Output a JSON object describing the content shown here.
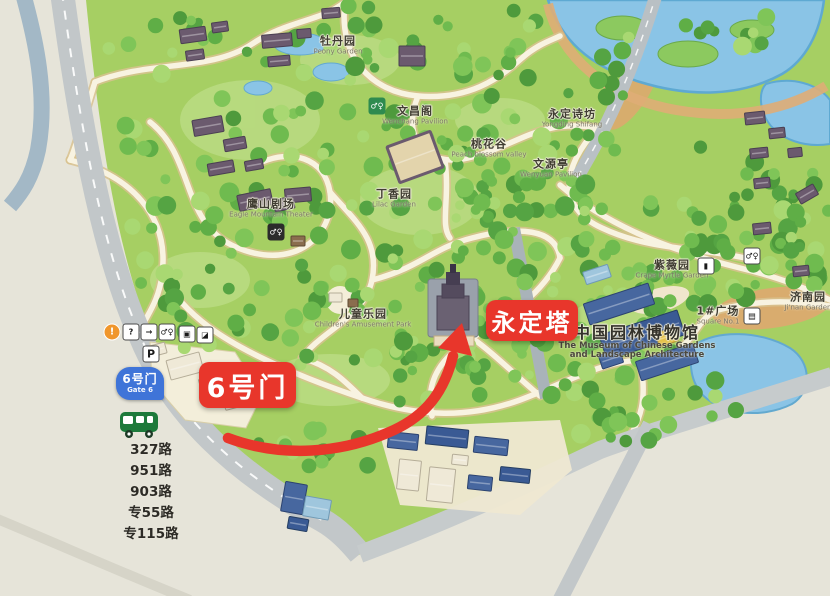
{
  "annotations": {
    "gate": "6号门",
    "tower": "永定塔"
  },
  "gate_badge": {
    "name_zh": "6号门",
    "name_en": "Gate 6"
  },
  "bus_routes": [
    "327路",
    "951路",
    "903路",
    "专55路",
    "专115路"
  ],
  "places": [
    {
      "id": "peony-garden",
      "zh": "牡丹园",
      "en": "Peony Garden",
      "x": 338,
      "y": 44
    },
    {
      "id": "wenchang-pavilion",
      "zh": "文昌阁",
      "en": "Wenchang Pavilion",
      "x": 415,
      "y": 114
    },
    {
      "id": "yongding-poetry-fang",
      "zh": "永定诗坊",
      "en": "Yongding Shifang",
      "x": 572,
      "y": 117
    },
    {
      "id": "peach-blossom-valley",
      "zh": "桃花谷",
      "en": "Peach blossom valley",
      "x": 489,
      "y": 147
    },
    {
      "id": "wenyuan-pavilion",
      "zh": "文源亭",
      "en": "Wenyuan Pavilion",
      "x": 551,
      "y": 167
    },
    {
      "id": "lilac-garden",
      "zh": "丁香园",
      "en": "Lilac Garden",
      "x": 394,
      "y": 197
    },
    {
      "id": "eagle-mountain-theater",
      "zh": "鹰山剧场",
      "en": "Eagle Mountain Theater",
      "x": 271,
      "y": 207
    },
    {
      "id": "childrens-playground",
      "zh": "儿童乐园",
      "en": "Children's Amusement Park",
      "x": 363,
      "y": 317
    },
    {
      "id": "crape-myrtle-garden",
      "zh": "紫薇园",
      "en": "Crape Myrtle Garden",
      "x": 672,
      "y": 268
    },
    {
      "id": "jinan-garden",
      "zh": "济南园",
      "en": "Ji'nan Garden",
      "x": 808,
      "y": 300
    },
    {
      "id": "square-no1",
      "zh": "1#广场",
      "en": "Square No.1",
      "x": 718,
      "y": 314
    },
    {
      "id": "garden-museum",
      "zh": "中国园林博物馆",
      "en": "The Museum of Chinese Gardens",
      "en2": "and Landscape Architecture",
      "x": 637,
      "y": 340,
      "big": true
    }
  ],
  "facility_icons": [
    {
      "id": "info-icon",
      "glyph": "!",
      "x": 112,
      "y": 332,
      "style": "circle"
    },
    {
      "id": "help-icon",
      "glyph": "?",
      "x": 131,
      "y": 332,
      "style": "box"
    },
    {
      "id": "exit-icon",
      "glyph": "→",
      "x": 149,
      "y": 332,
      "style": "box"
    },
    {
      "id": "restroom-icon",
      "glyph": "♂♀",
      "x": 167,
      "y": 332,
      "style": "box"
    },
    {
      "id": "gallery-icon",
      "glyph": "▣",
      "x": 187,
      "y": 334,
      "style": "box"
    },
    {
      "id": "shop-icon",
      "glyph": "◪",
      "x": 205,
      "y": 335,
      "style": "box"
    },
    {
      "id": "parking-icon",
      "glyph": "P",
      "x": 151,
      "y": 354,
      "style": "box parking"
    },
    {
      "id": "restroom-hill-icon",
      "glyph": "♂♀",
      "x": 276,
      "y": 232,
      "style": "dark"
    },
    {
      "id": "restroom-green-icon",
      "glyph": "♂♀",
      "x": 377,
      "y": 106,
      "style": "green"
    },
    {
      "id": "restroom-right-icon",
      "glyph": "♂♀",
      "x": 752,
      "y": 256,
      "style": "box"
    },
    {
      "id": "car-icon",
      "glyph": "▮",
      "x": 706,
      "y": 266,
      "style": "box"
    },
    {
      "id": "square-plaza-icon",
      "glyph": "▤",
      "x": 752,
      "y": 316,
      "style": "box"
    }
  ],
  "colors": {
    "annotation_red": "#e8362b",
    "gate_badge_blue": "#3f74d8",
    "bus_green": "#1d7a3b",
    "park_green": "#a6cf63",
    "water_blue": "#8ac4e6"
  }
}
